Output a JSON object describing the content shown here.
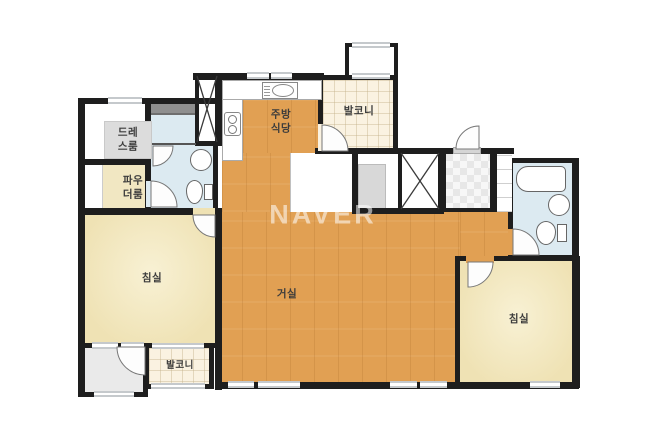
{
  "watermark": "NAVER",
  "rooms": {
    "dress_room": {
      "label": "드레스룸"
    },
    "powder_room": {
      "label": "파우더룸"
    },
    "kitchen_dining": {
      "label": "주방식당"
    },
    "balcony_top": {
      "label": "발코니"
    },
    "balcony_bottom": {
      "label": "발코니"
    },
    "living_room": {
      "label": "거실"
    },
    "bedroom_left": {
      "label": "침실"
    },
    "bedroom_right": {
      "label": "침실"
    }
  },
  "colors": {
    "wall": "#1E1E1E",
    "wood": "#E1A053",
    "bedroom": "#EFE2B4",
    "bedroomlight": "#F8F1D4",
    "tile": "#FAF2E1",
    "bath": "#DCEAF1",
    "powder": "#F1E7C2",
    "rug": "#DCDCDC",
    "grayroom": "#EAEAEA",
    "storage": "#D8D8D8",
    "checkerlight": "#F7F7F7",
    "checkerdark": "#E7E7E7",
    "windowgray": "#C5C9CC",
    "labelcolor": "#3B3B3B",
    "watermark": "rgba(255,255,255,0.55)"
  }
}
